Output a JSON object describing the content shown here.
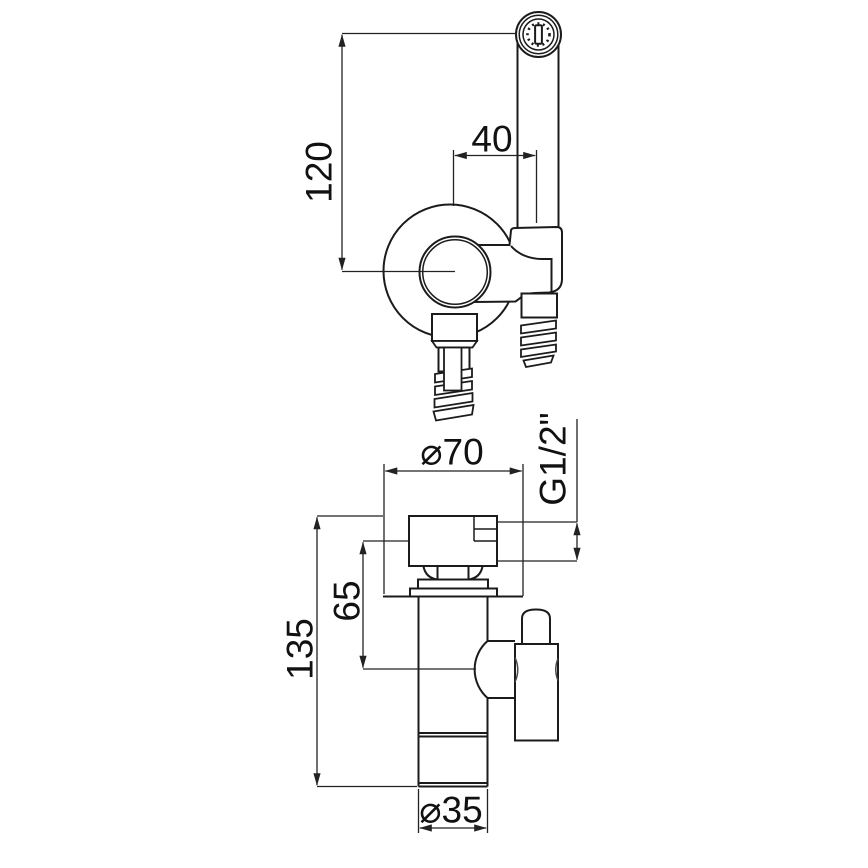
{
  "drawing": {
    "background_color": "#ffffff",
    "line_color": "#1b1b1b",
    "dimension_color": "#222222",
    "top_view": {
      "dim_handle_height": "120",
      "dim_handle_offset": "40"
    },
    "front_view": {
      "dim_plate_diameter": "⌀70",
      "dim_thread_size": "G1/2\"",
      "dim_outlet_height": "65",
      "dim_total_height": "135",
      "dim_body_diameter": "⌀35"
    }
  }
}
